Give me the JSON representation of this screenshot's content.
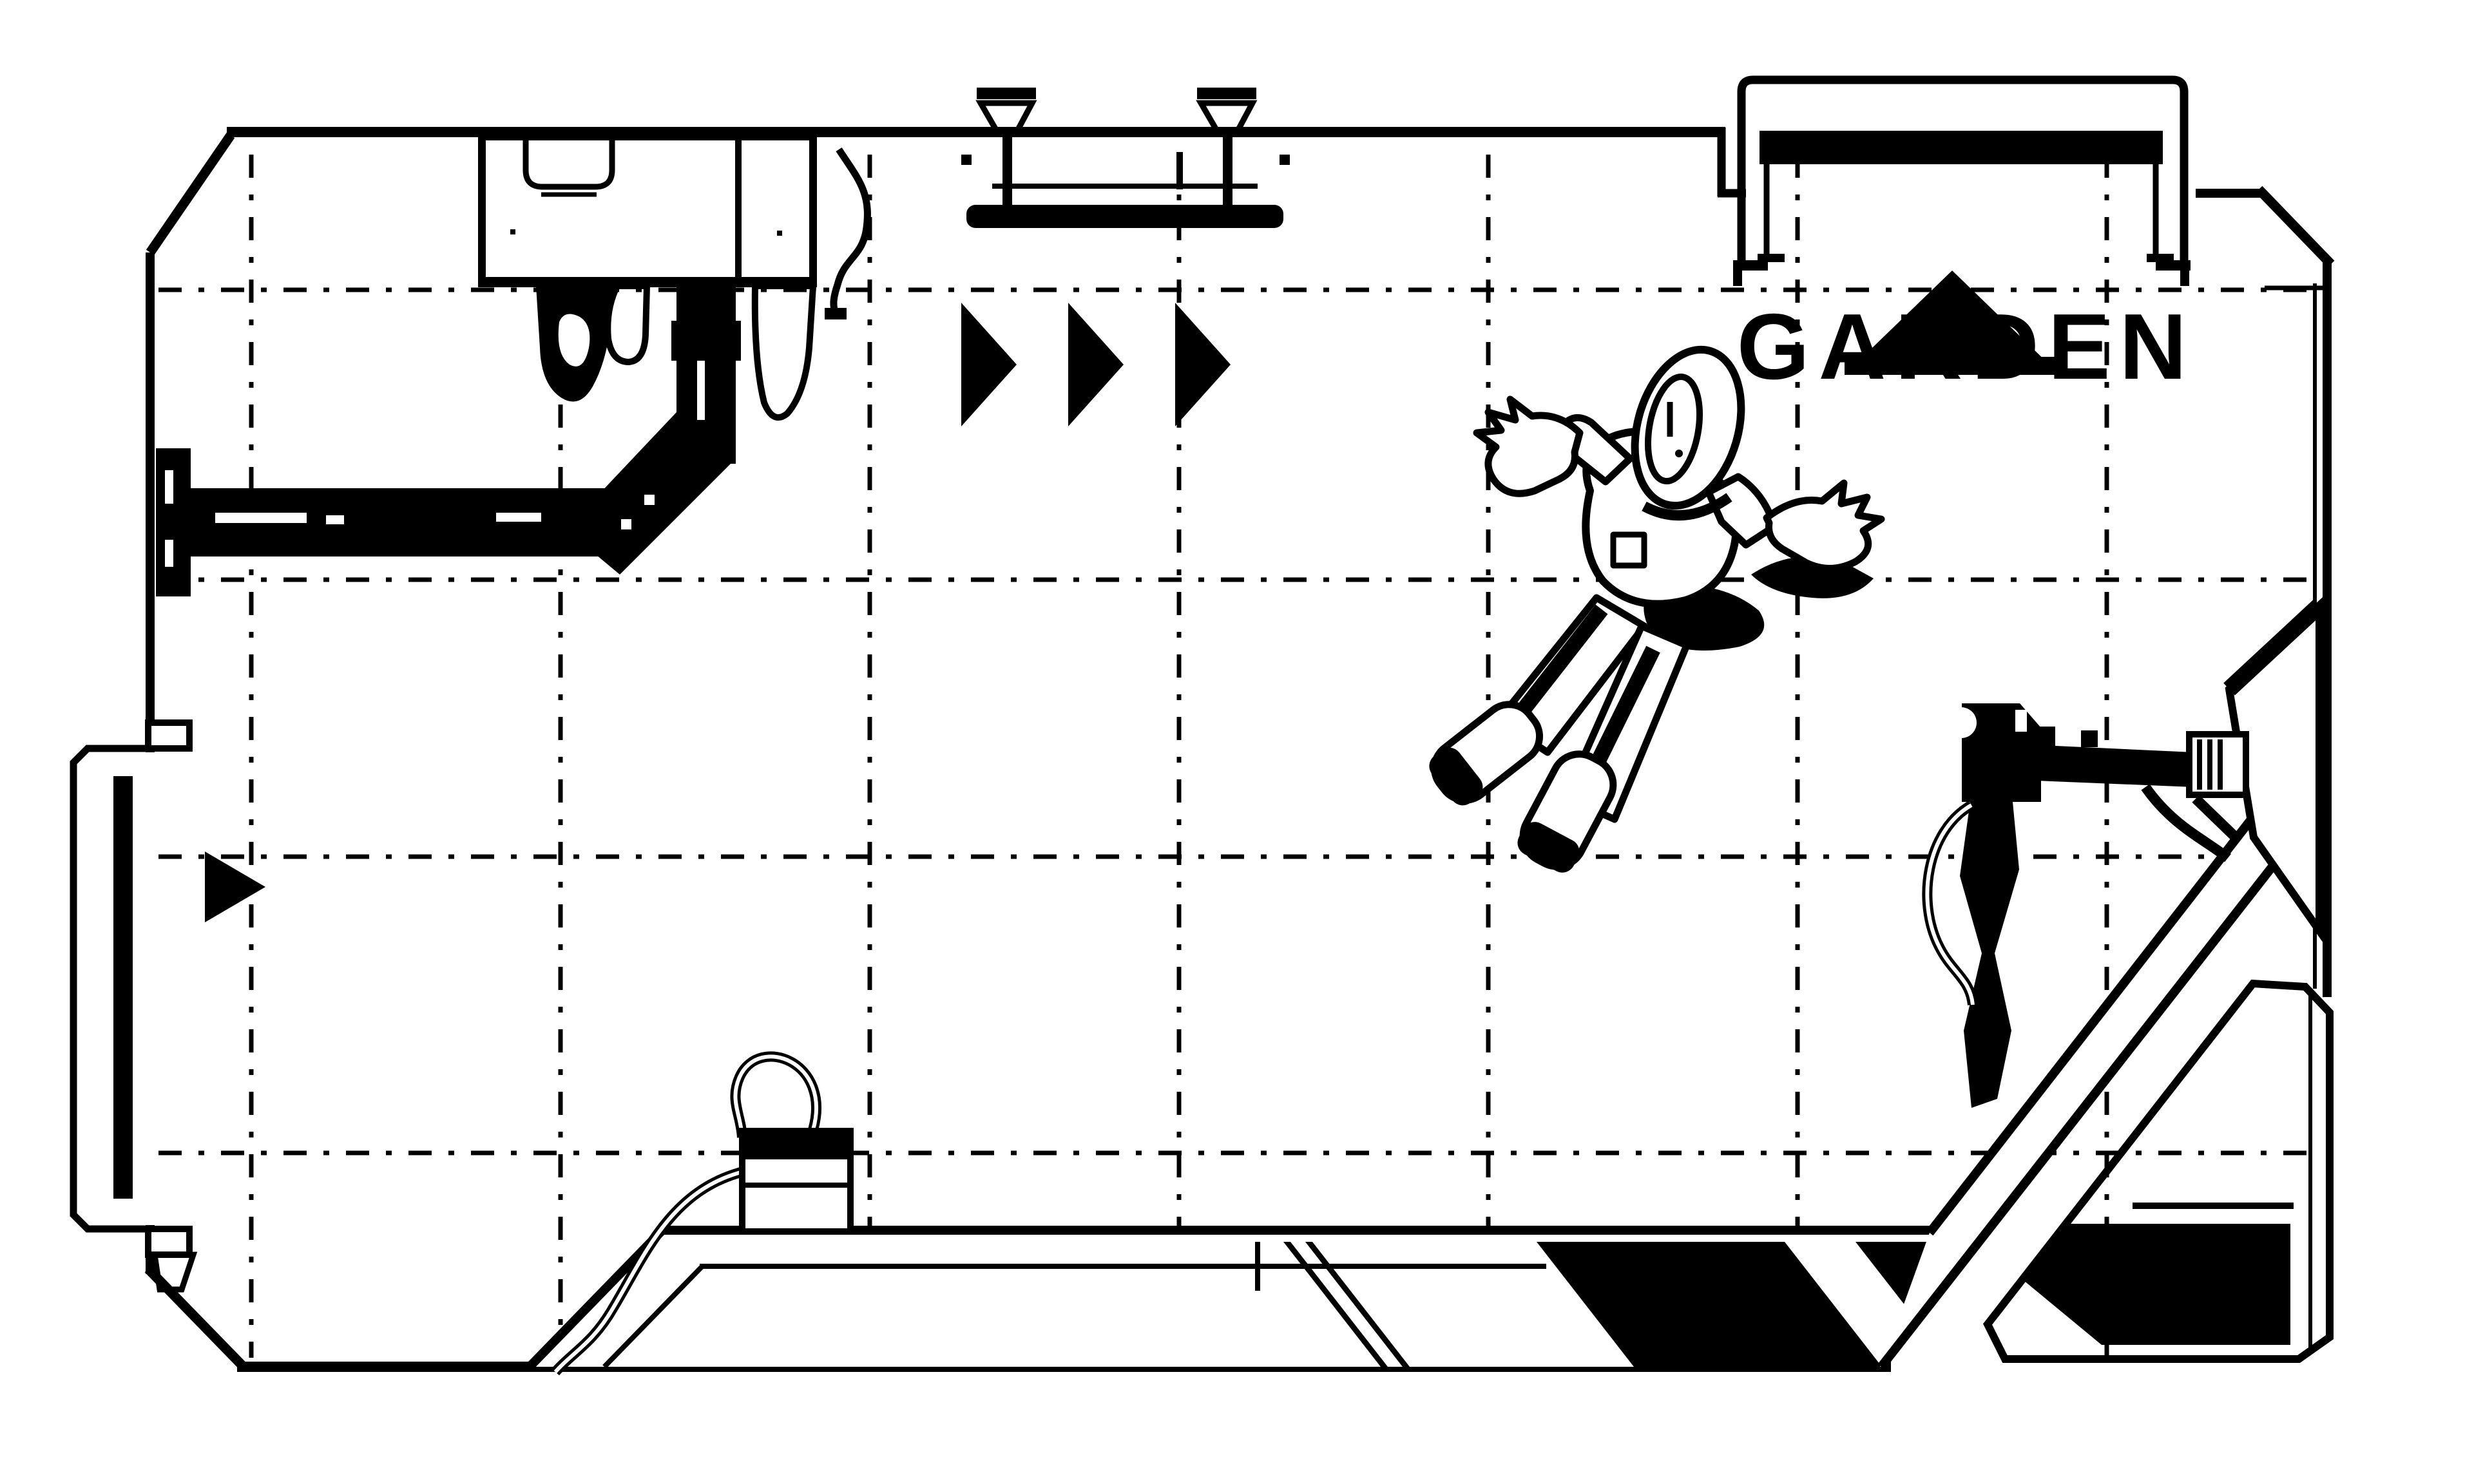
{
  "colors": {
    "ink": "#000000",
    "paper": "#ffffff"
  },
  "sign": {
    "label": "GARDEN",
    "icon": "triangle-up-icon"
  },
  "indicators": {
    "conveyor_arrow_count": 3,
    "door_arrow_count": 1
  },
  "entities": {
    "player": "astronaut-floating"
  }
}
